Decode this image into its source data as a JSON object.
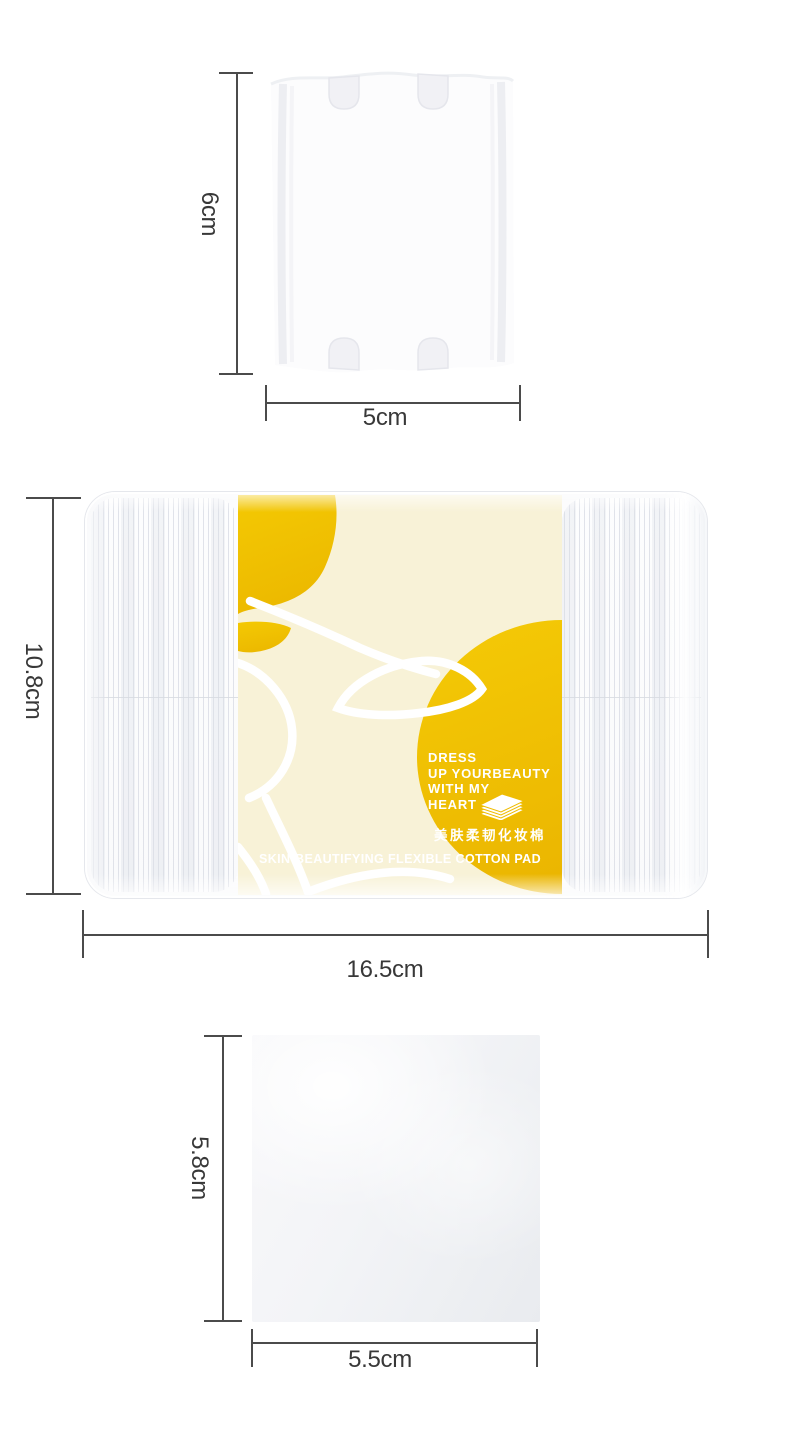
{
  "colors": {
    "accent_yellow": "#F2C300",
    "accent_yellow_deep": "#EAB600",
    "label_cream": "#F8F2D7",
    "measure_line": "#4B4B4B",
    "measure_text": "#383838"
  },
  "product": {
    "single_pad": {
      "height": "6cm",
      "width": "5cm"
    },
    "package": {
      "height": "10.8cm",
      "width": "16.5cm",
      "label": {
        "slogan_lines": [
          "DRESS",
          "UP YOURBEAUTY",
          "WITH MY",
          "HEART"
        ],
        "product_name_cn": "美肤柔韧化妆棉",
        "product_name_en": "SKIN-BEAUTIFYING FLEXIBLE COTTON PAD"
      }
    },
    "inner_pad": {
      "height": "5.8cm",
      "width": "5.5cm"
    }
  }
}
